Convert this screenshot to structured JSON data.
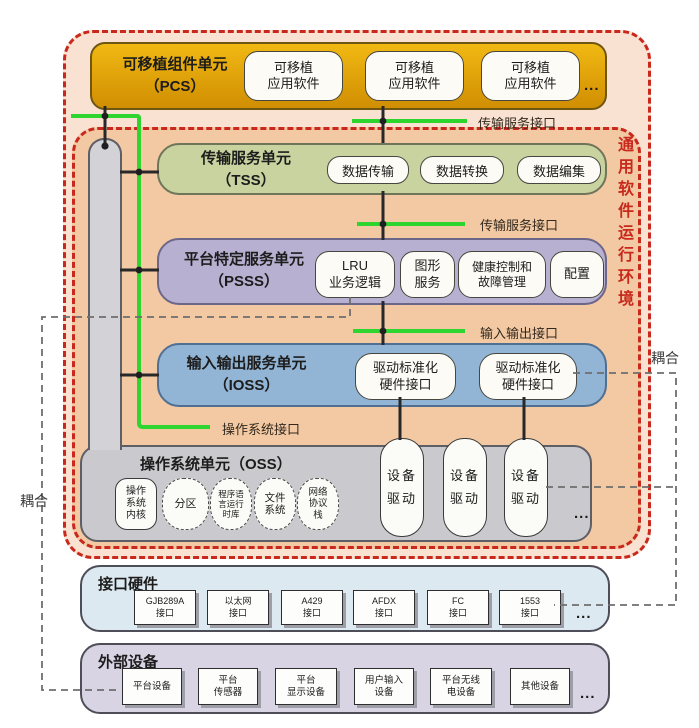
{
  "env": {
    "runtime_label": "通用软件运行环境"
  },
  "pcs": {
    "title": "可移植组件单元\n（PCS）",
    "apps": [
      "可移植\n应用软件",
      "可移植\n应用软件",
      "可移植\n应用软件"
    ],
    "more": "..."
  },
  "tss": {
    "title": "传输服务单元\n（TSS）",
    "items": [
      "数据传输",
      "数据转换",
      "数据编集"
    ]
  },
  "psss": {
    "title": "平台特定服务单元\n（PSSS）",
    "items": [
      "LRU\n业务逻辑",
      "图形\n服务",
      "健康控制和\n故障管理",
      "配置"
    ]
  },
  "ioss": {
    "title": "输入输出服务单元\n（IOSS）",
    "items": [
      "驱动标准化\n硬件接口",
      "驱动标准化\n硬件接口"
    ]
  },
  "oss": {
    "title": "操作系统单元（OSS）",
    "items": [
      "操作\n系统\n内核",
      "分区",
      "程序语\n言运行\n时库",
      "文件\n系统",
      "网络\n协议\n栈"
    ],
    "drivers": [
      "设备\n驱动",
      "设备\n驱动",
      "设备\n驱动"
    ],
    "more": "..."
  },
  "hw": {
    "title": "接口硬件",
    "items": [
      "GJB289A\n接口",
      "以太网\n接口",
      "A429\n接口",
      "AFDX\n接口",
      "FC\n接口",
      "1553\n接口"
    ],
    "more": "..."
  },
  "ext": {
    "title": "外部设备",
    "items": [
      "平台设备",
      "平台\n传感器",
      "平台\n显示设备",
      "用户输入\n设备",
      "平台无线\n电设备",
      "其他设备"
    ],
    "more": "..."
  },
  "labels": {
    "transport_iface_top": "传输服务接口",
    "transport_iface_mid": "传输服务接口",
    "io_iface": "输入输出接口",
    "os_iface": "操作系统接口",
    "coupling_left": "耦合",
    "coupling_right": "耦合"
  },
  "colors": {
    "frame_red": "#c9281c",
    "interface_green": "#2ed52e",
    "pcs_gold": "#e8a806",
    "tss_green": "#c9d3a0",
    "psss_purple": "#b7b0d1",
    "ioss_blue": "#92b4d5",
    "oss_gray": "#cacace",
    "hw_blue": "#dde9f1",
    "ext_lavender": "#d9d4e4",
    "env_outer_bg": "#f9e2d1",
    "env_inner_bg": "#f2c9a3"
  }
}
